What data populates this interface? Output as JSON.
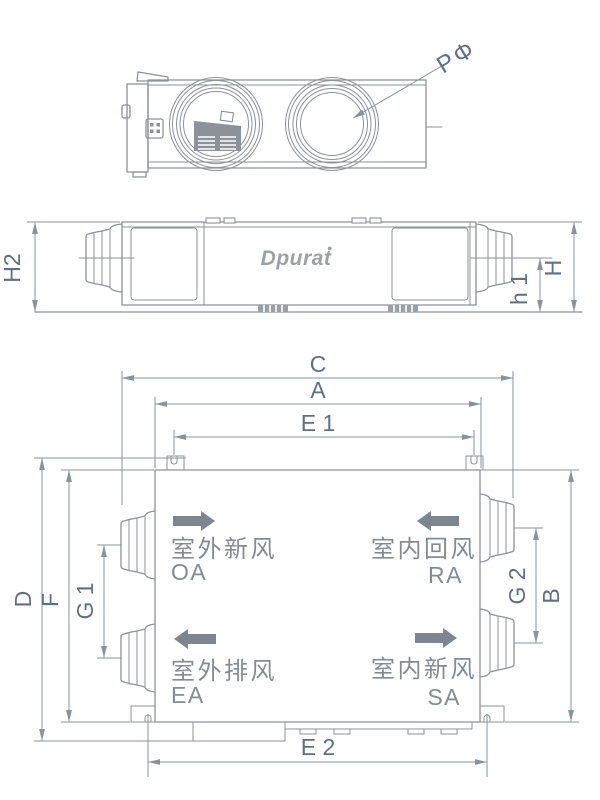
{
  "colors": {
    "line": "#8b929a",
    "dimension_line": "#8594a0",
    "dimension_text": "#5c7186",
    "label_text": "#848c93",
    "flow_arrow": "#7d8690",
    "logo": "#9ba1a7",
    "background": "#ffffff"
  },
  "top_view": {
    "diameter_label": "PΦ"
  },
  "side_view": {
    "logo": "Dpurat",
    "logo_mark": "●",
    "dims": {
      "h2": "H2",
      "h1": "h 1",
      "h": "H"
    }
  },
  "bottom_view": {
    "dims": {
      "c": "C",
      "a": "A",
      "e1": "E 1",
      "e2": "E 2",
      "d": "D",
      "f": "F",
      "g1": "G 1",
      "g2": "G 2",
      "b": "B"
    },
    "ports": {
      "oa": {
        "name": "室外新风",
        "code": "OA",
        "direction": "in-right"
      },
      "ra": {
        "name": "室内回风",
        "code": "RA",
        "direction": "in-left"
      },
      "ea": {
        "name": "室外排风",
        "code": "EA",
        "direction": "out-left"
      },
      "sa": {
        "name": "室内新风",
        "code": "SA",
        "direction": "out-right"
      }
    }
  }
}
